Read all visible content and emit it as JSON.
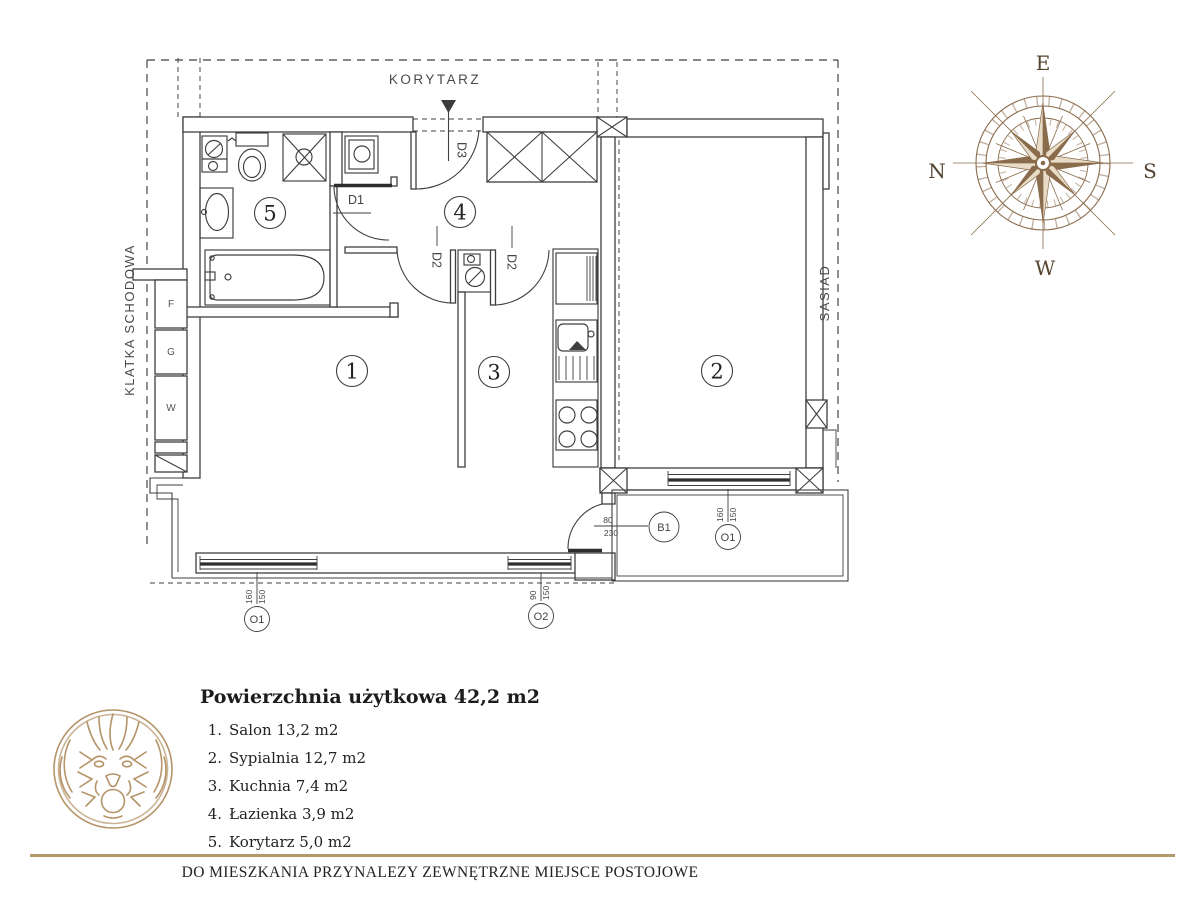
{
  "plan": {
    "corridor": "KORYTARZ",
    "stairwell": "KLATKA SCHODOWA",
    "neighbor": "SASIAD",
    "shafts": [
      "F",
      "G",
      "W"
    ],
    "room_numbers": [
      "1",
      "2",
      "3",
      "4",
      "5"
    ],
    "door_labels": {
      "d1": "D1",
      "d2": "D2",
      "d3": "D3"
    },
    "balcony_door": {
      "label": "B1",
      "width": "80",
      "height": "230"
    },
    "window_markers": [
      {
        "label": "O1",
        "width": "160",
        "height": "150"
      },
      {
        "label": "O2",
        "width": "90",
        "height": "150"
      },
      {
        "label": "O1",
        "width": "160",
        "height": "150"
      }
    ]
  },
  "compass": {
    "top": "E",
    "left": "N",
    "right": "S",
    "bottom": "W"
  },
  "legend": {
    "title": "Powierzchnia użytkowa 42,2 m2",
    "items": [
      {
        "num": "1.",
        "label": "Salon 13,2 m2"
      },
      {
        "num": "2.",
        "label": "Sypialnia 12,7 m2"
      },
      {
        "num": "3.",
        "label": "Kuchnia 7,4 m2"
      },
      {
        "num": "4.",
        "label": "Łazienka 3,9 m2"
      },
      {
        "num": "5.",
        "label": "Korytarz 5,0 m2"
      }
    ]
  },
  "footer": {
    "note": "DO MIESZKANIA PRZYNALEZY ZEWNĘTRZNE MIEJSCE POSTOJOWE"
  }
}
